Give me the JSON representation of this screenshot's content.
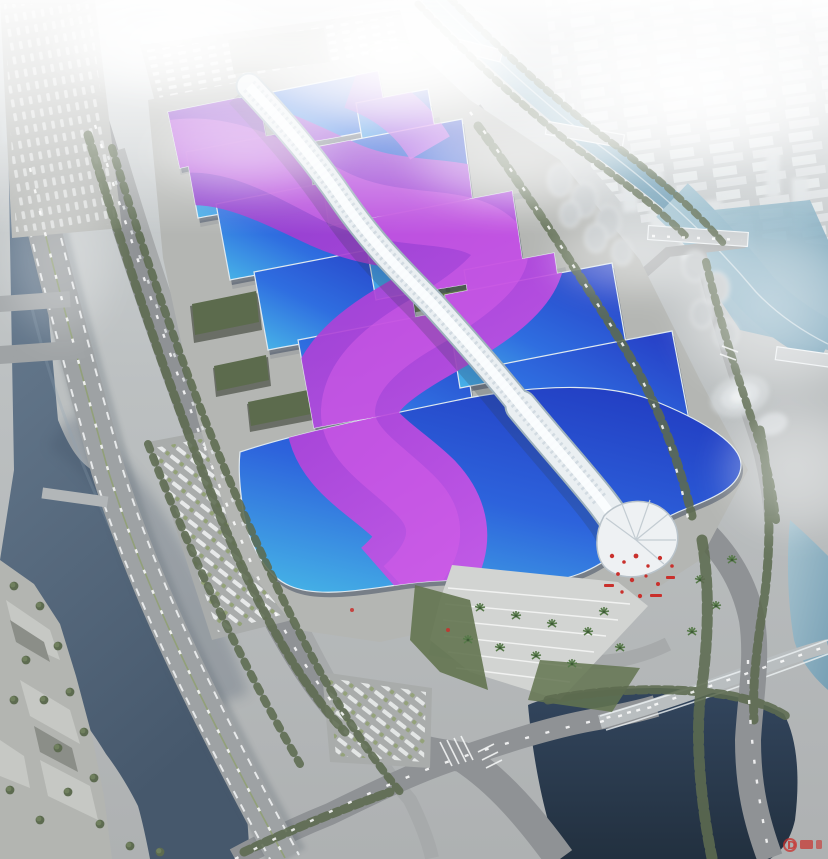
{
  "scene": {
    "description": "Aerial rendering of a large exhibition and convention center: paired blue exhibition halls with purple ribbon roofs flanking a white serpentine central concourse, surrounded by roads, canals, parks and a hazy city skyline",
    "palette": {
      "roof_blue_light": "#49b8e8",
      "roof_blue_mid": "#2f6ee0",
      "roof_blue_deep": "#2742c8",
      "roof_purple": "#8d35c8",
      "roof_magenta": "#d45ce8",
      "spine_white": "#eaeff2",
      "plaza_gray": "#b4b6b3",
      "road_gray": "#8f9295",
      "river_slate": "#5d7186",
      "pond_navy": "#2c3d52",
      "canal_teal": "#7fa9bf",
      "tree_green": "#5d6b50",
      "haze_white": "#ffffff",
      "accent_red": "#c9302c"
    }
  },
  "watermark": {
    "text": "D",
    "color": "#c9302c"
  }
}
